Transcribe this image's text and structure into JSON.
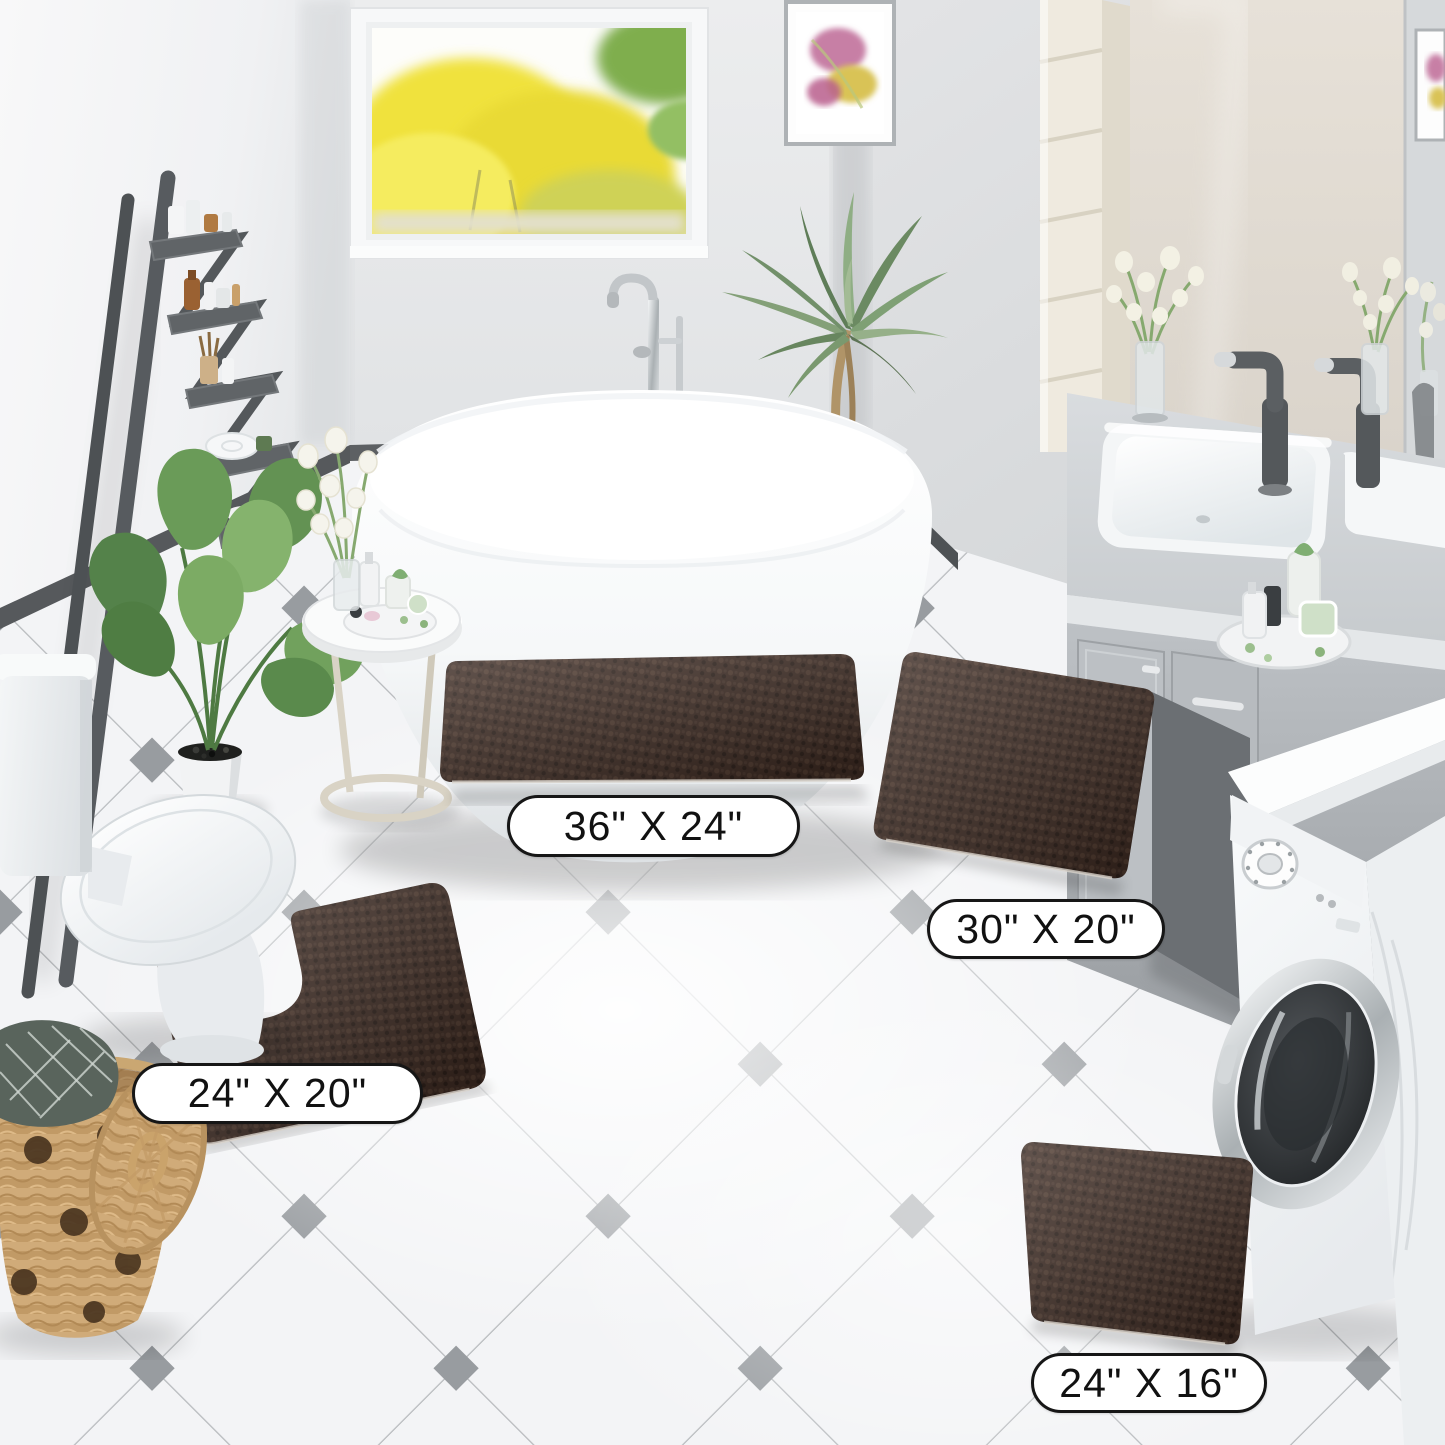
{
  "labels": {
    "rug_36x24": "36\" X 24\"",
    "rug_30x20": "30\" X 20\"",
    "rug_24x20": "24\" X 20\"",
    "rug_24x16": "24\" X 16\""
  },
  "colors": {
    "rug_brown": "#3C2A22",
    "rug_brown_light": "#4D382D",
    "rug_brown_dark": "#2B1E18",
    "floor_tile": "#F3F4F6",
    "tile_line": "#B6B9BC",
    "tile_accent": "#989CA0",
    "wall_left": "#F4F4F6",
    "wall_back": "#E7E9EB",
    "wall_right": "#D9DBDD",
    "baseboard": "#54585B",
    "counter_gray": "#CFD3D6",
    "vanity_gray": "#B7BBBF",
    "ladder_gray": "#595D61",
    "plant_green": "#6F9C5C",
    "palm_green": "#84A078",
    "window_yellow": "#F0E23C",
    "basket_tan": "#D4B286",
    "label_bg": "#FFFFFF",
    "label_border": "#161616",
    "label_text": "#111111"
  }
}
